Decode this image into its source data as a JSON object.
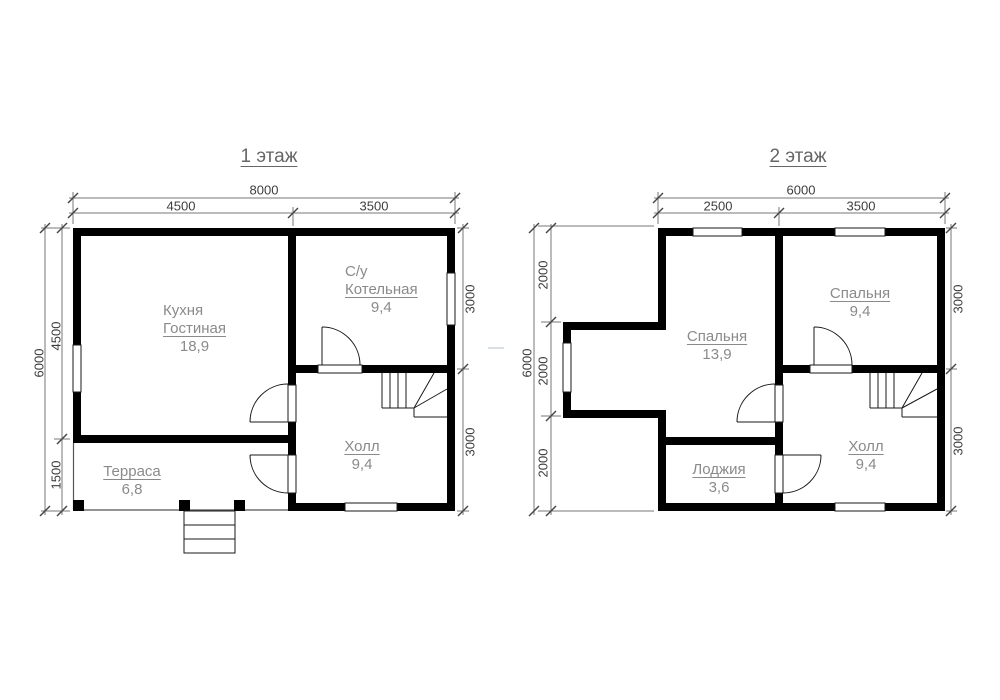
{
  "colors": {
    "background": "#ffffff",
    "wall": "#000000",
    "line": "#1a1a1a",
    "dim_line": "#777777",
    "dim_tick": "#444444",
    "dim_text": "#3d3d3d",
    "room_text": "#8a8a8a",
    "title_text": "#666666",
    "divider_dash": "#dadfe4"
  },
  "floor1": {
    "title": "1 этаж",
    "dims": {
      "width_total": "8000",
      "width_a": "4500",
      "width_b": "3500",
      "height_total": "6000",
      "height_a": "4500",
      "height_b": "1500",
      "right_a": "3000",
      "right_b": "3000"
    },
    "rooms": {
      "kitchen_living": {
        "line1": "Кухня",
        "line2": "Гостиная",
        "area": "18,9"
      },
      "boiler": {
        "line1": "С/у",
        "line2": "Котельная",
        "area": "9,4"
      },
      "hall": {
        "name": "Холл",
        "area": "9,4"
      },
      "terrace": {
        "name": "Терраса",
        "area": "6,8"
      }
    }
  },
  "floor2": {
    "title": "2 этаж",
    "dims": {
      "width_total": "6000",
      "width_a": "2500",
      "width_b": "3500",
      "height_total": "6000",
      "height_a": "2000",
      "height_b": "2000",
      "height_c": "2000",
      "right_a": "3000",
      "right_b": "3000"
    },
    "rooms": {
      "bedroom_large": {
        "name": "Спальня",
        "area": "13,9"
      },
      "bedroom_small": {
        "name": "Спальня",
        "area": "9,4"
      },
      "hall": {
        "name": "Холл",
        "area": "9,4"
      },
      "loggia": {
        "name": "Лоджия",
        "area": "3,6"
      }
    }
  }
}
